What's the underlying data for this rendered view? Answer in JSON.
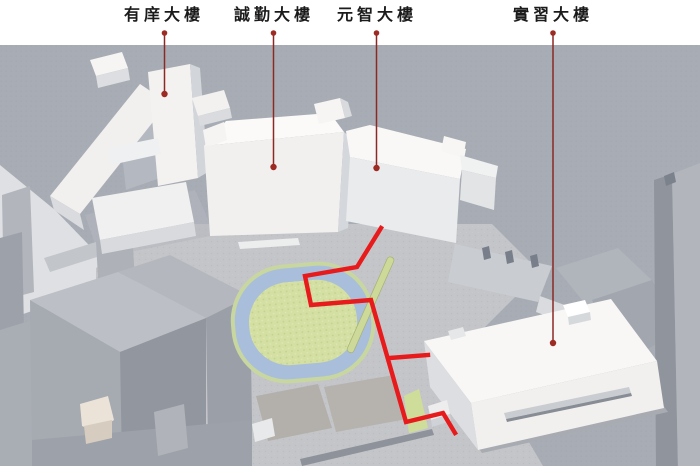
{
  "diagram": {
    "type": "campus-3d-annotated-site-map",
    "labels": [
      {
        "id": "youxiang",
        "text": "有庠大樓"
      },
      {
        "id": "chengqin",
        "text": "誠勤大樓"
      },
      {
        "id": "yuanzhi",
        "text": "元智大樓"
      },
      {
        "id": "shixi",
        "text": "實習大樓"
      }
    ],
    "route": {
      "main_points": "381,228 357,267 305,276 311,305 371,300 406,422 443,413 455,433",
      "branch_points": "390,358 428,355"
    },
    "colors": {
      "route": "#e71a1c",
      "leader": "#8b2a24",
      "marker": "#9e2b23",
      "track": "#a9bedb",
      "field": "#d4dfa4",
      "field_edge": "#c8d79f",
      "ground": "#a8adb5",
      "plaza": "#c4c5c9",
      "building": "#f2f1ef",
      "label_text": "#1b1b1b"
    }
  }
}
